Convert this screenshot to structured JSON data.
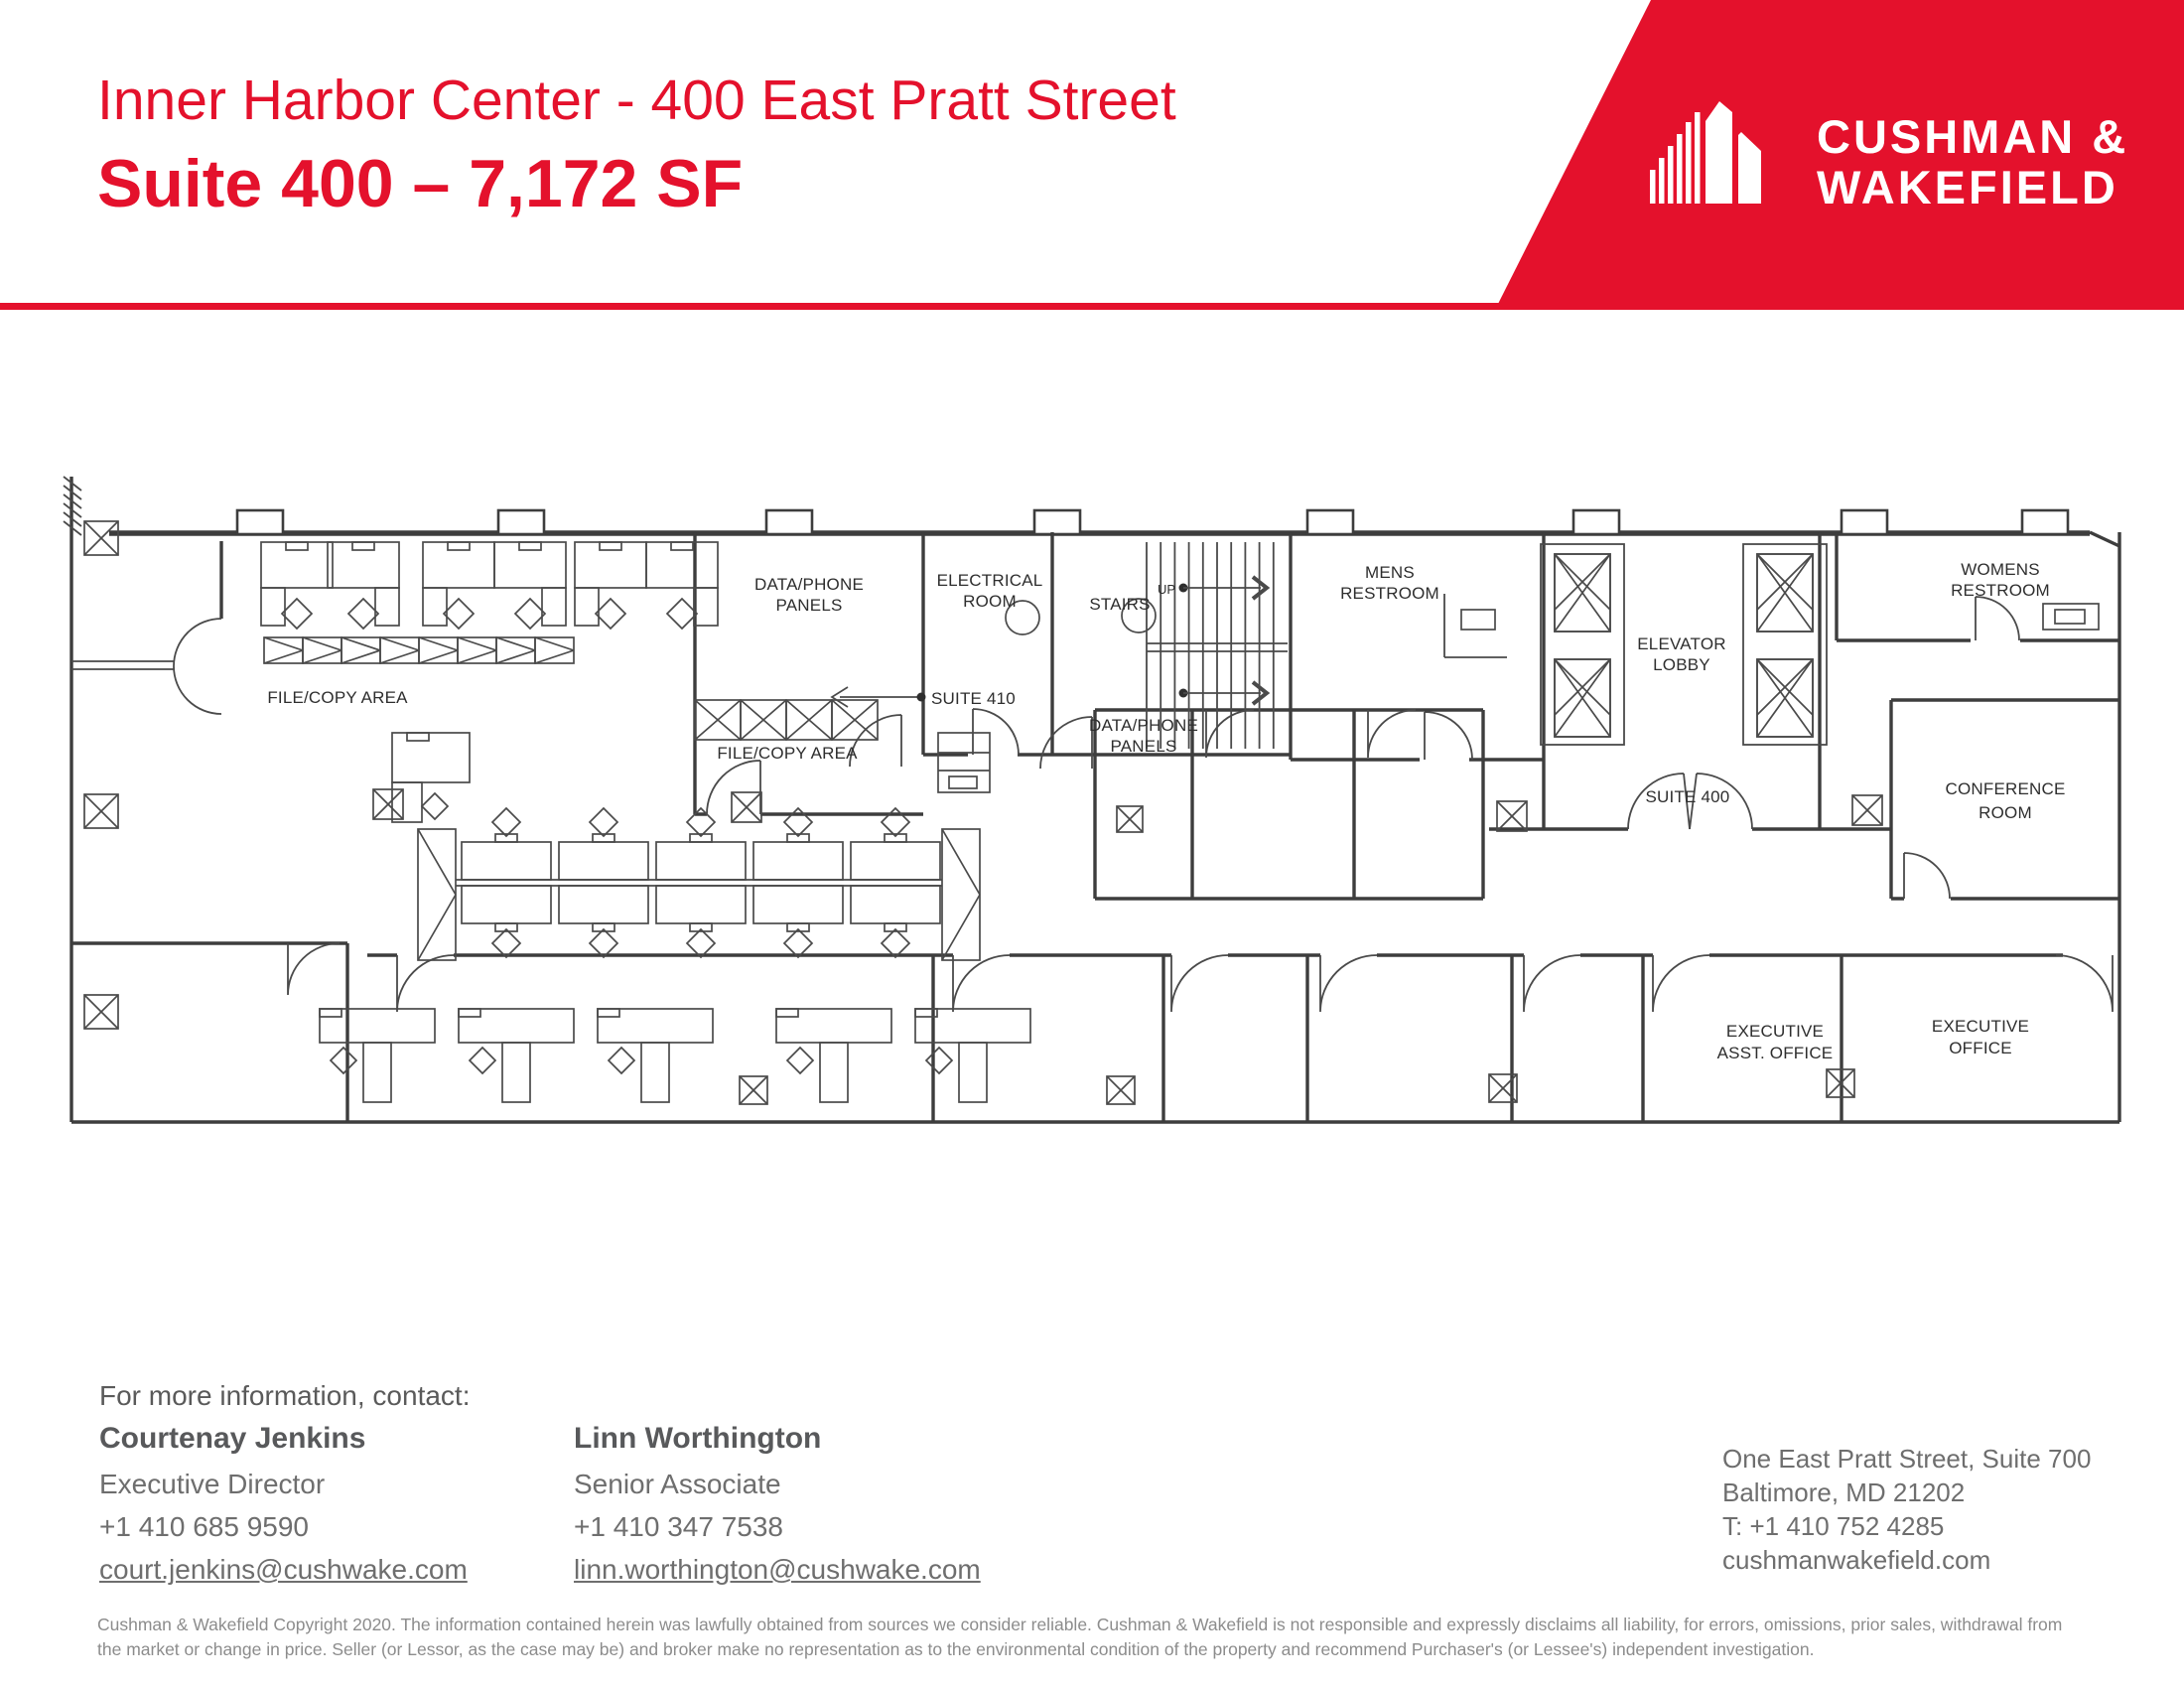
{
  "header": {
    "title": "Inner Harbor Center - 400 East Pratt Street",
    "subtitle": "Suite 400 – 7,172 SF",
    "brand_line1": "CUSHMAN &",
    "brand_line2": "WAKEFIELD",
    "accent_color": "#E4112C"
  },
  "plan": {
    "labels": {
      "file_copy_1": "FILE/COPY AREA",
      "file_copy_2": "FILE/COPY AREA",
      "data_phone_1a": "DATA/PHONE",
      "data_phone_1b": "PANELS",
      "electrical_a": "ELECTRICAL",
      "electrical_b": "ROOM",
      "stairs": "STAIRS",
      "up": "UP",
      "mens_a": "MENS",
      "mens_b": "RESTROOM",
      "elevator_a": "ELEVATOR",
      "elevator_b": "LOBBY",
      "womens_a": "WOMENS",
      "womens_b": "RESTROOM",
      "suite410": "SUITE 410",
      "suite400": "SUITE 400",
      "data_phone_2a": "DATA/PHONE",
      "data_phone_2b": "PANELS",
      "conference_a": "CONFERENCE",
      "conference_b": "ROOM",
      "exec_asst_a": "EXECUTIVE",
      "exec_asst_b": "ASST. OFFICE",
      "exec_office_a": "EXECUTIVE",
      "exec_office_b": "OFFICE"
    }
  },
  "contact": {
    "heading": "For more information, contact:",
    "people": [
      {
        "name": "Courtenay Jenkins",
        "title": "Executive Director",
        "phone": "+1 410 685 9590",
        "email": "court.jenkins@cushwake.com"
      },
      {
        "name": "Linn Worthington",
        "title": "Senior Associate",
        "phone": "+1 410 347 7538",
        "email": "linn.worthington@cushwake.com"
      }
    ],
    "office": {
      "address1": "One East Pratt Street, Suite 700",
      "address2": "Baltimore, MD 21202",
      "phone": "T: +1 410 752 4285",
      "web": "cushmanwakefield.com"
    }
  },
  "disclaimer": "Cushman & Wakefield Copyright 2020. The information contained herein was lawfully obtained from sources we consider reliable. Cushman & Wakefield is not responsible and expressly disclaims all liability, for errors, omissions, prior sales, withdrawal from the market or change in price. Seller (or Lessor, as the case may be) and broker make no representation as to the environmental condition of the property and recommend Purchaser's (or Lessee's) independent investigation."
}
